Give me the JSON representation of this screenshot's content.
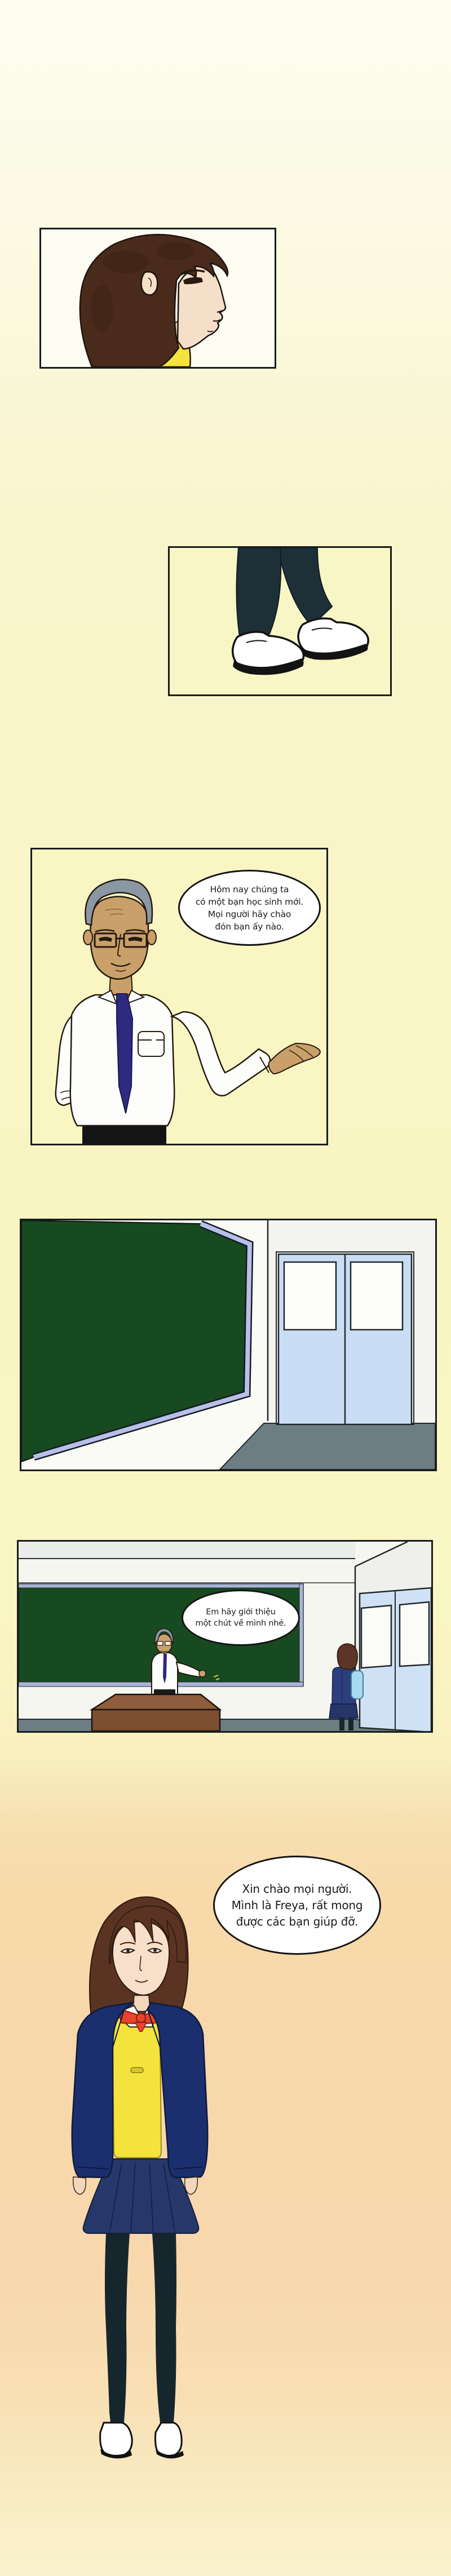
{
  "comic": {
    "language": "Vietnamese",
    "bubbles": {
      "teacher_intro": {
        "speaker": "teacher",
        "lines": [
          "Hôm nay chúng ta",
          "có một bạn học sinh mới.",
          "Mọi người hãy chào",
          "đón bạn ấy nào."
        ]
      },
      "teacher_prompt": {
        "speaker": "teacher",
        "lines": [
          "Em hãy giới thiệu",
          "một chút về mình nhé."
        ]
      },
      "freya_greeting": {
        "speaker": "Freya",
        "lines": [
          "Xin chào mọi người.",
          "Mình là Freya, rất mong",
          "được các bạn giúp đỡ."
        ]
      }
    },
    "colors": {
      "page_top": "#fdfdf1",
      "page_yellow": "#f9f5c3",
      "page_peach": "#f8d8ac",
      "panel_border": "#181d1d",
      "chalkboard_green": "#174a20",
      "chalkboard_frame": "#b7c0ea",
      "door_blue": "#c9ddf5",
      "floor_gray": "#6d7d84",
      "teacher_hair_gray": "#8b97a3",
      "teacher_skin": "#c9a06a",
      "tie_navy": "#2e2a80",
      "girl_hair_brown": "#5a3322",
      "girl_skin": "#f7dfc9",
      "blazer_navy": "#1b2f6e",
      "sweater_yellow": "#f2e23c",
      "bow_red": "#e8432b",
      "skirt_navy": "#263769",
      "tights_dark": "#16262d",
      "backpack_blue": "#a9d9f0",
      "shoe_white": "#ffffff"
    }
  }
}
